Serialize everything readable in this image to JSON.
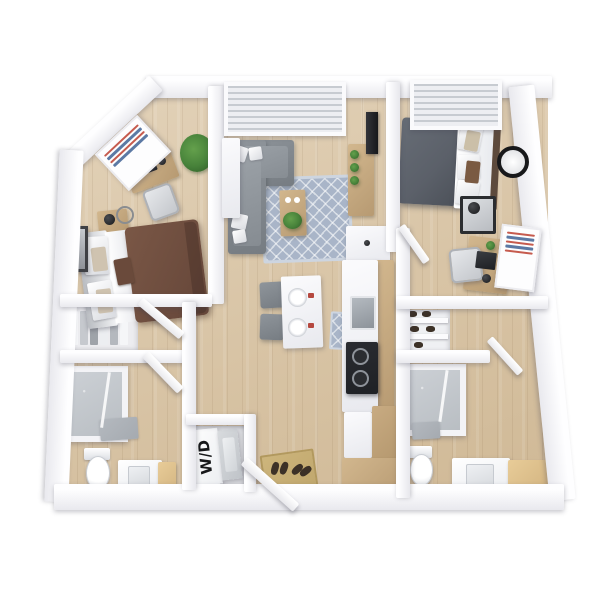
{
  "labels": {
    "washer_dryer": "W/D"
  },
  "colors": {
    "floor": "#d9c3a1",
    "wall": "#f8f8fa",
    "wood": "#d2b78e",
    "wood_dark": "#b79a72",
    "plant": "#47823a",
    "rug": "#a9b5c8",
    "bed1_duvet": "#7a5746",
    "bed2_duvet": "#5b6069",
    "sofa": "#878d93",
    "cooktop": "#1f2125",
    "bath_floor": "#b9bec3",
    "mat_gray": "#a5aab0",
    "entry_mat": "#c1a86e",
    "poster_red": "#c65b4e",
    "poster_blue": "#5c79a4",
    "napkin": "#b5483f"
  },
  "rooms": [
    {
      "name": "bedroom-1",
      "items": [
        "desk",
        "office-chair",
        "laptop",
        "headphones",
        "plant",
        "wall-poster",
        "bed-brown-duvet",
        "nightstand",
        "lamp",
        "wall-frame",
        "closet-hanging-clothes"
      ]
    },
    {
      "name": "living-room",
      "items": [
        "window-blinds",
        "sectional-sofa",
        "throw-pillows",
        "trellis-rug",
        "coffee-table",
        "plant",
        "tv-console",
        "tv",
        "storage-cabinet"
      ]
    },
    {
      "name": "bedroom-2",
      "items": [
        "window-blinds",
        "bed-gray-duvet",
        "wall-clock",
        "nightstand",
        "lamp",
        "desk",
        "office-chair",
        "laptop",
        "leaning-poster"
      ]
    },
    {
      "name": "dining-area",
      "items": [
        "table",
        "two-chairs",
        "two-place-settings"
      ]
    },
    {
      "name": "kitchen",
      "items": [
        "counter",
        "sink",
        "cooktop",
        "fridge",
        "pantry-cabinet",
        "base-cabinet",
        "floor-mat"
      ]
    },
    {
      "name": "bathroom-1",
      "items": [
        "shower",
        "bath-mat",
        "toilet",
        "vanity-sink",
        "cabinet"
      ]
    },
    {
      "name": "bathroom-2",
      "items": [
        "shower",
        "bath-mat",
        "toilet",
        "vanity-sink",
        "cabinet"
      ]
    },
    {
      "name": "laundry-closet",
      "items": [
        "stacked-washer-dryer"
      ]
    },
    {
      "name": "entry",
      "items": [
        "front-door",
        "doormat",
        "shoes"
      ]
    },
    {
      "name": "hall-closets",
      "items": [
        "shoe-shelves"
      ]
    }
  ]
}
